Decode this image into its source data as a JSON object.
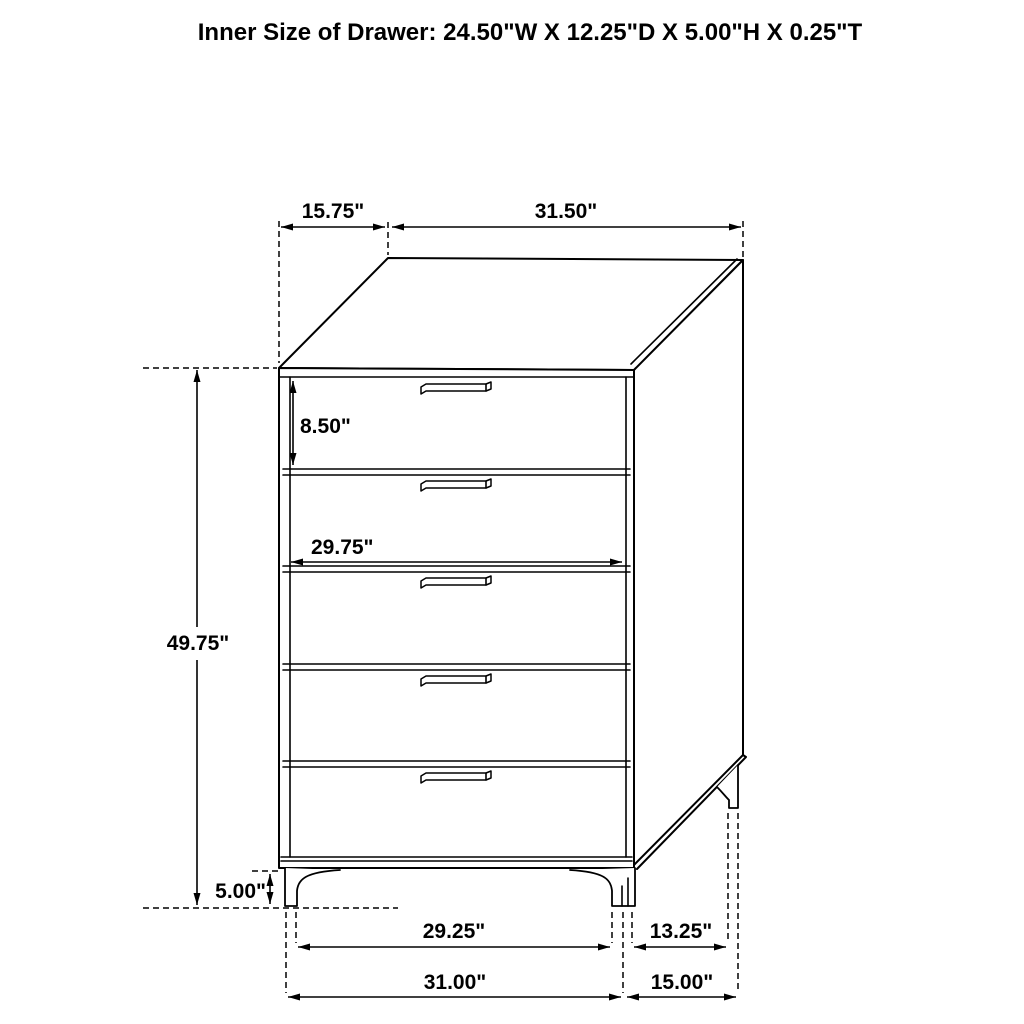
{
  "title": "Inner Size of Drawer: 24.50\"W X 12.25\"D X 5.00\"H X 0.25\"T",
  "figure": {
    "item": "five-drawer-chest-dimension-diagram",
    "drawer_count": 5,
    "line_color": "#000000",
    "background_color": "#ffffff",
    "dimensions": {
      "top_depth": "15.75\"",
      "top_width": "31.50\"",
      "drawer_face_height": "8.50\"",
      "drawer_face_width": "29.75\"",
      "overall_height": "49.75\"",
      "leg_height": "5.00\"",
      "leg_inner_width": "29.25\"",
      "leg_inner_depth": "13.25\"",
      "overall_width": "31.00\"",
      "overall_depth": "15.00\""
    }
  }
}
